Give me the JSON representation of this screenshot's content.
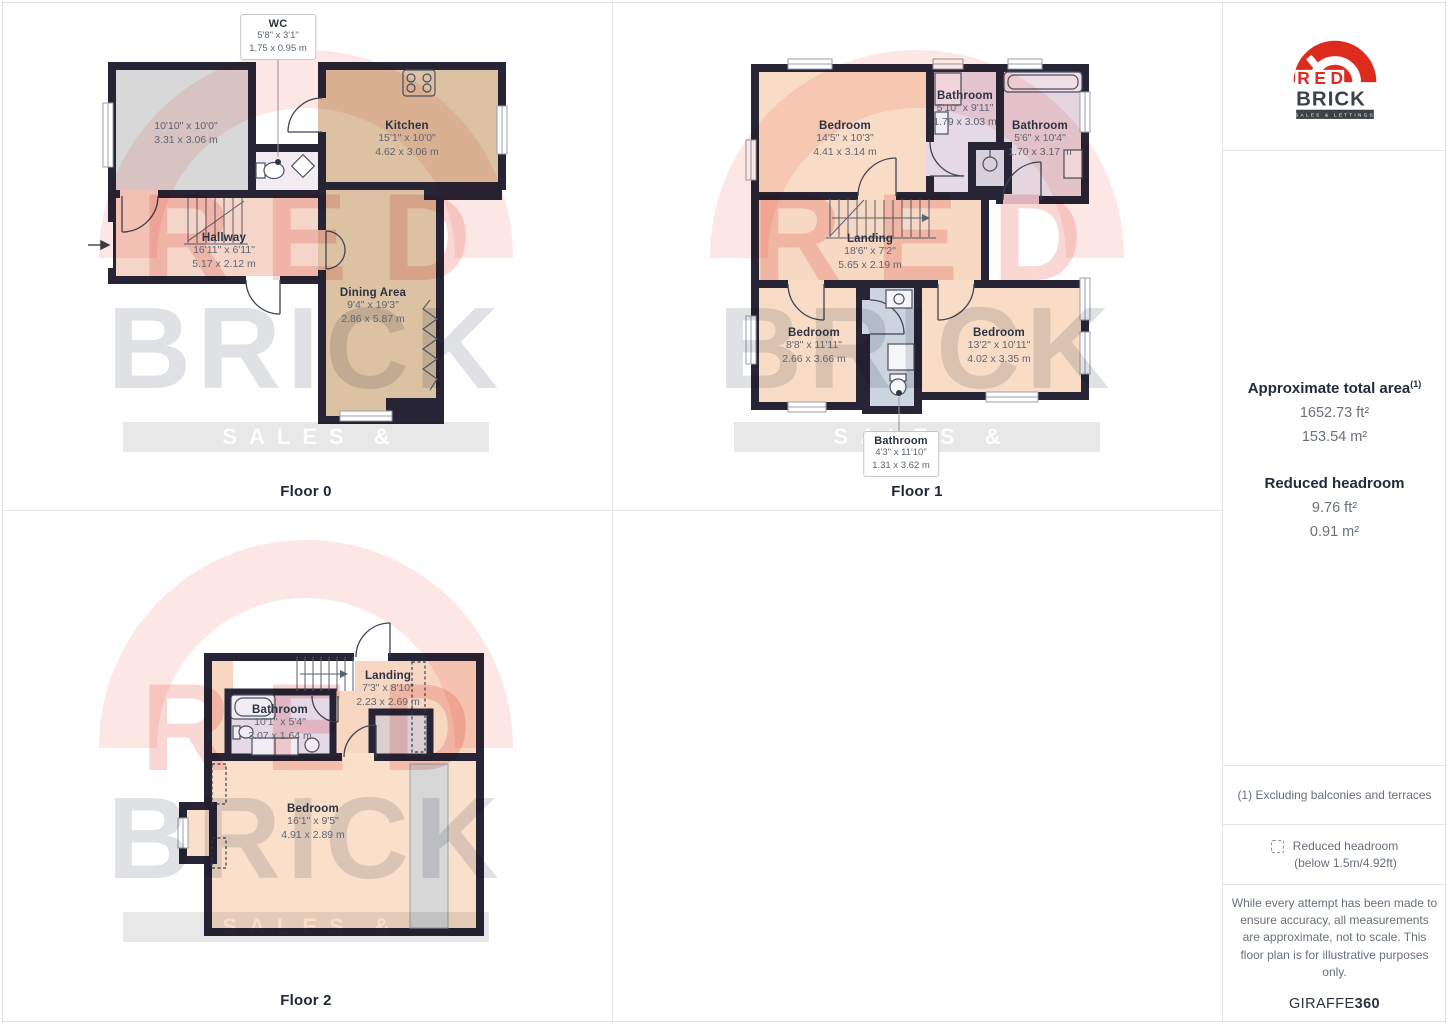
{
  "watermark": {
    "line1": "RED",
    "line2": "BRICK",
    "bar": "SALES & LETTINGS"
  },
  "colors": {
    "wall": "#272435",
    "bedroom_fill": "#f9dcc5",
    "kitchen_fill": "#dcc2a3",
    "bathroom_fill": "#e5d8e7",
    "bath_blue_fill": "#ccd4e0",
    "store_fill": "#d9d8d8",
    "brand_red": "#dd2b1e",
    "brand_charcoal": "#3c4246"
  },
  "floors": {
    "floor0": {
      "caption": "Floor 0",
      "rooms": {
        "store": {
          "imperial": "10'10\" x 10'0\"",
          "metric": "3.31 x 3.06 m"
        },
        "kitchen": {
          "name": "Kitchen",
          "imperial": "15'1\" x 10'0\"",
          "metric": "4.62 x 3.06 m"
        },
        "hallway": {
          "name": "Hallway",
          "imperial": "16'11\" x 6'11\"",
          "metric": "5.17 x 2.12 m"
        },
        "dining": {
          "name": "Dining Area",
          "imperial": "9'4\" x 19'3\"",
          "metric": "2.86 x 5.87 m"
        },
        "wc": {
          "name": "WC",
          "imperial": "5'8\" x 3'1\"",
          "metric": "1.75 x 0.95 m"
        }
      }
    },
    "floor1": {
      "caption": "Floor 1",
      "rooms": {
        "bedroom_tl": {
          "name": "Bedroom",
          "imperial": "14'5\" x 10'3\"",
          "metric": "4.41 x 3.14 m"
        },
        "bathroom_tm": {
          "name": "Bathroom",
          "imperial": "5'10\" x 9'11\"",
          "metric": "1.79 x 3.03 m"
        },
        "bathroom_tr": {
          "name": "Bathroom",
          "imperial": "5'6\" x 10'4\"",
          "metric": "1.70 x 3.17 m"
        },
        "landing": {
          "name": "Landing",
          "imperial": "18'6\" x 7'2\"",
          "metric": "5.65 x 2.19 m"
        },
        "bedroom_bl": {
          "name": "Bedroom",
          "imperial": "8'8\" x 11'11\"",
          "metric": "2.66 x 3.66 m"
        },
        "bedroom_br": {
          "name": "Bedroom",
          "imperial": "13'2\" x 10'11\"",
          "metric": "4.02 x 3.35 m"
        },
        "bathroom_bm": {
          "name": "Bathroom",
          "imperial": "4'3\" x 11'10\"",
          "metric": "1.31 x 3.62 m"
        }
      }
    },
    "floor2": {
      "caption": "Floor 2",
      "rooms": {
        "landing": {
          "name": "Landing",
          "imperial": "7'3\" x 8'10\"",
          "metric": "2.23 x 2.69 m"
        },
        "bathroom": {
          "name": "Bathroom",
          "imperial": "10'1\" x 5'4\"",
          "metric": "3.07 x 1.64 m"
        },
        "bedroom": {
          "name": "Bedroom",
          "imperial": "16'1\" x 9'5\"",
          "metric": "4.91 x 2.89 m"
        }
      }
    }
  },
  "sidebar": {
    "logo": {
      "red": "RED",
      "brick": "BRICK",
      "tagline": "SALES & LETTINGS"
    },
    "area_title": "Approximate total area",
    "area_footnote_marker": "(1)",
    "area_ft": "1652.73 ft²",
    "area_m": "153.54 m²",
    "headroom_title": "Reduced headroom",
    "headroom_ft": "9.76 ft²",
    "headroom_m": "0.91 m²",
    "footnote": "(1) Excluding balconies and terraces",
    "legend_title": "Reduced headroom",
    "legend_subtitle": "(below 1.5m/4.92ft)",
    "disclaimer": "While every attempt has been made to ensure accuracy, all measurements are approximate, not to scale. This floor plan is for illustrative purposes only.",
    "brand_name": "GIRAFFE",
    "brand_bold": "360"
  }
}
